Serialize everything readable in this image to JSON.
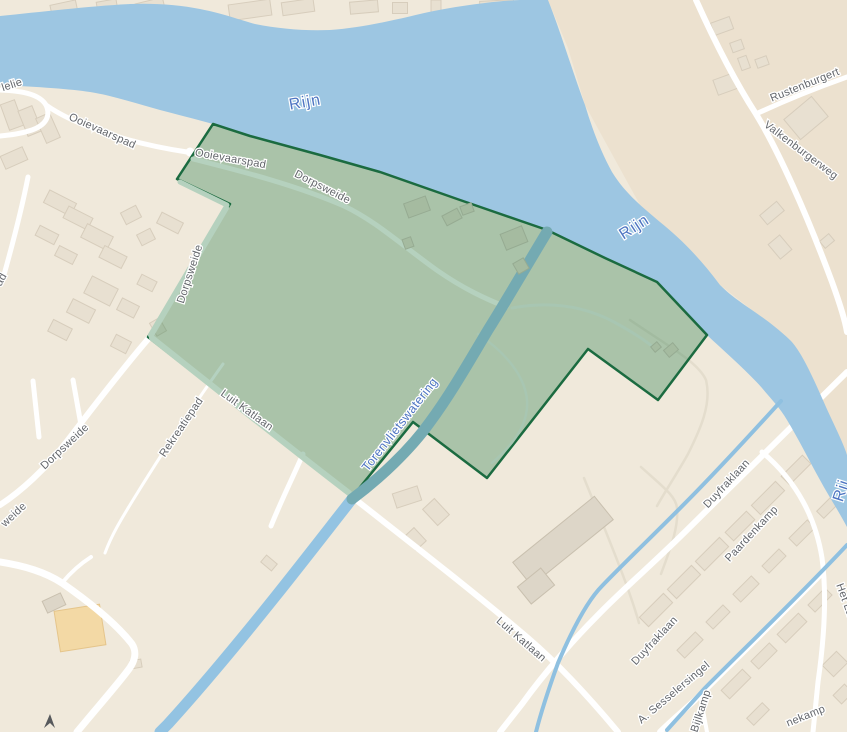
{
  "colors": {
    "land": "#f0e9db",
    "land_ne": "#ece1cf",
    "water": "#9dc6e2",
    "canal_outside": "#93c3e2",
    "canal_inside_overlay": "#74aab2",
    "overlay_fill": "#2e7d4f",
    "overlay_border": "#1b6b40",
    "road": "#ffffff",
    "street_label": "#63666b",
    "water_label": "#4e75c2",
    "building": "#e8e0d1",
    "landmark_yellow": "#f3d9a5"
  },
  "map": {
    "labels": [
      {
        "text": "lelie",
        "kind": "street"
      },
      {
        "text": "Ooievaarspad",
        "kind": "street"
      },
      {
        "text": "Ooievaarspad",
        "kind": "street"
      },
      {
        "text": "Dorpsweide",
        "kind": "street"
      },
      {
        "text": "Dorpsweide",
        "kind": "street"
      },
      {
        "text": "Dorpsweide",
        "kind": "street"
      },
      {
        "text": "weide",
        "kind": "street-partial"
      },
      {
        "text": "Rekreatiepad",
        "kind": "street"
      },
      {
        "text": "Luit Katlaan",
        "kind": "street"
      },
      {
        "text": "Luit Katlaan",
        "kind": "street"
      },
      {
        "text": "Torenvlietswatering",
        "kind": "water"
      },
      {
        "text": "Rijn",
        "kind": "water"
      },
      {
        "text": "Rijn",
        "kind": "water"
      },
      {
        "text": "Rij",
        "kind": "water-partial"
      },
      {
        "text": "Rustenburgert",
        "kind": "street-partial"
      },
      {
        "text": "Valkenburgerweg",
        "kind": "street"
      },
      {
        "text": "Duyfraklaan",
        "kind": "street"
      },
      {
        "text": "Paardenkamp",
        "kind": "street"
      },
      {
        "text": "Duyfraklaan",
        "kind": "street"
      },
      {
        "text": "A. Sesselersingel",
        "kind": "street"
      },
      {
        "text": "Bijlkamp",
        "kind": "street-partial"
      },
      {
        "text": "nekamp",
        "kind": "street-partial"
      },
      {
        "text": "Het La",
        "kind": "street-partial"
      },
      {
        "text": "ad",
        "kind": "street-partial"
      }
    ]
  }
}
